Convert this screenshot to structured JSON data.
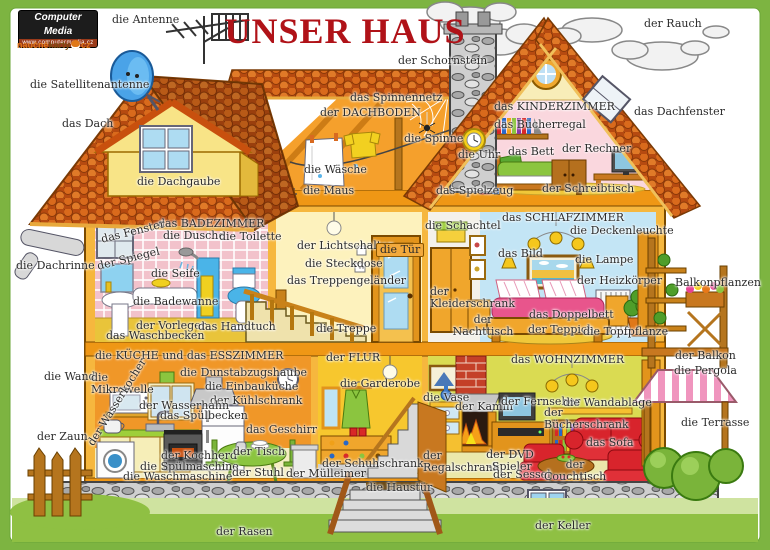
{
  "frame": {
    "border_color": "#7db441",
    "title_color": "#b01218"
  },
  "title": "UNSER HAUS",
  "branding": {
    "logo1_name": "Computer Media",
    "logo1_url": "www.computermedia.cz",
    "logo2_a": "naučné",
    "logo2_b": "karty",
    "logo2_c": "cz"
  },
  "labels": {
    "antenne": "die Antenne",
    "rauch": "der Rauch",
    "satellitenantenne": "die Satellitenantenne",
    "schornstein": "der Schornstein",
    "dach": "das Dach",
    "dachfenster": "das Dachfenster",
    "spinnennetz": "das Spinnennetz",
    "dachboden": "der DACHBODEN",
    "kinderzimmer": "das KINDERZIMMER",
    "buecherregal": "das Bücherregal",
    "spinne": "die Spinne",
    "uhr": "die Uhr",
    "bett": "das Bett",
    "rechner": "der Rechner",
    "waesche": "die Wäsche",
    "maus": "die Maus",
    "spielzeug": "das Spielzeug",
    "schreibtisch": "der Schreibtisch",
    "dachgaube": "die Dachgaube",
    "badezimmer": "das BADEZIMMER",
    "dusche": "die Dusche",
    "toilette": "die Toilette",
    "fenster": "das Fenster",
    "spiegel": "der Spiegel",
    "seife": "die Seife",
    "badewanne": "die Badewanne",
    "vorleger": "der Vorleger",
    "handtuch": "das Handtuch",
    "waschbecken": "das Waschbecken",
    "dachrinne": "die Dachrinne",
    "lichtschalter": "der Lichtschalter",
    "steckdose": "die Steckdose",
    "tuer": "die Tür",
    "treppengelaender": "das Treppengeländer",
    "treppe": "die Treppe",
    "schlafzimmer": "das SCHLAFZIMMER",
    "schachtel": "die Schachtel",
    "deckenleuchte": "die Deckenleuchte",
    "bild": "das Bild",
    "lampe": "die Lampe",
    "heizkoerper": "der Heizkörper",
    "kleiderschrank": "der\nKleiderschrank",
    "doppelbett": "das Doppelbett",
    "nachttisch": "der\nNachttisch",
    "teppich": "der Teppich",
    "topfpflanze": "die Topfpflanze",
    "balkonpflanzen": "Balkonpflanzen",
    "balkon": "der Balkon",
    "pergola": "die Pergola",
    "terrasse": "die Terrasse",
    "kueche": "die KÜCHE und das ESSZIMMER",
    "wand": "die Wand",
    "mikrowelle": "die\nMikrowelle",
    "dunstabzugshaube": "die Dunstabzugshaube",
    "einbaukueche": "die Einbauküche",
    "kuehlschrank": "der Kühlschrank",
    "wasserhahn": "der Wasserhahn",
    "spuelbecken": "das Spülbecken",
    "wasserkocher": "der Wasserkocher",
    "geschirr": "das Geschirr",
    "zaun": "der Zaun",
    "kochherd": "der Kochherd",
    "spuelmaschine": "die Spülmaschine",
    "waschmaschine": "die Waschmaschine",
    "tisch": "der Tisch",
    "stuhl": "der Stuhl",
    "muelleimer": "der Mülleimer",
    "rasen": "der Rasen",
    "flur": "der FLUR",
    "garderobe": "die Garderobe",
    "schuhschrank": "der Schuhschrank",
    "haustuer": "die Haustür",
    "wohnzimmer": "das WOHNZIMMER",
    "vase": "die Vase",
    "kamin": "der Kamin",
    "fernseher": "der Fernseher",
    "wandablage": "die Wandablage",
    "buecherschrank": "der\nBücherschrank",
    "sofa": "das Sofa",
    "regalschrank": "der\nRegalschrank",
    "dvdspieler": "der DVD\n-Spieler",
    "sessel": "der Sessel",
    "couchtisch": "der\nCouchtisch",
    "keller": "der Keller"
  }
}
